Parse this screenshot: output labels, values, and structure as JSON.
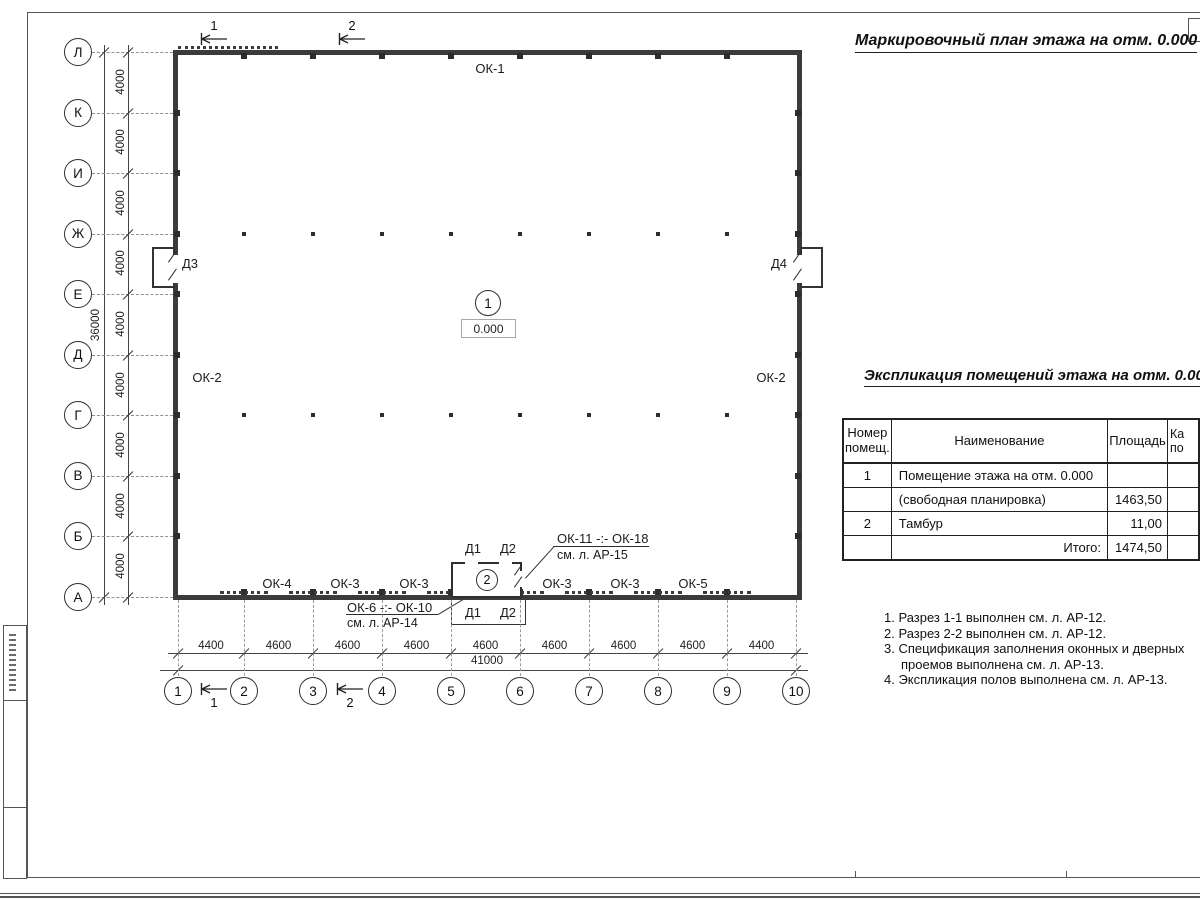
{
  "sheet": {
    "plan_title": "Маркировочный план этажа на отм. 0.000",
    "level_mark": "0.000",
    "room_mark_main": "1",
    "room_mark_vestibule": "2"
  },
  "axes": {
    "rows": [
      "Л",
      "К",
      "И",
      "Ж",
      "Е",
      "Д",
      "Г",
      "В",
      "Б",
      "А"
    ],
    "cols": [
      "1",
      "2",
      "3",
      "4",
      "5",
      "6",
      "7",
      "8",
      "9",
      "10"
    ],
    "row_spacing_label": "4000",
    "row_total_label": "36000",
    "col_bay_labels": [
      "4400",
      "4600",
      "4600",
      "4600",
      "4600",
      "4600",
      "4600",
      "4600",
      "4400"
    ],
    "col_total_label": "41000"
  },
  "sections": {
    "s1": "1",
    "s2": "2"
  },
  "openings": {
    "top_window": "ОК-1",
    "left_window": "ОК-2",
    "right_window": "ОК-2",
    "left_door": "Д3",
    "right_door": "Д4",
    "bottom_windows": [
      "ОК-4",
      "ОК-3",
      "ОК-3",
      "ОК-3",
      "ОК-3",
      "ОК-5"
    ],
    "vestibule_doors": [
      "Д1",
      "Д2"
    ],
    "leader_windows_upper": {
      "range": "ОК-11 -:- ОК-18",
      "ref": "см. л. АР-15"
    },
    "leader_windows_lower": {
      "range": "ОК-6 -:- ОК-10",
      "ref": "см. л. АР-14"
    }
  },
  "table": {
    "title": "Экспликация помещений этажа на отм. 0.000",
    "headers": {
      "number": "Номер помещ.",
      "name": "Наименование",
      "area": "Площадь",
      "category": "Ка по"
    },
    "rows": [
      {
        "number": "1",
        "name": "Помещение этажа на отм. 0.000",
        "area": ""
      },
      {
        "number": "",
        "name": "(свободная планировка)",
        "area": "1463,50"
      },
      {
        "number": "2",
        "name": "Тамбур",
        "area": "11,00"
      },
      {
        "number": "",
        "name": "Итого:",
        "area": "1474,50"
      }
    ]
  },
  "notes": [
    "1. Разрез 1-1 выполнен см. л. АР-12.",
    "2. Разрез 2-2 выполнен см. л. АР-12.",
    "3. Спецификация заполнения оконных и дверных проемов выполнена см. л. АР-13.",
    "4. Экспликация полов выполнена см. л. АР-13."
  ]
}
